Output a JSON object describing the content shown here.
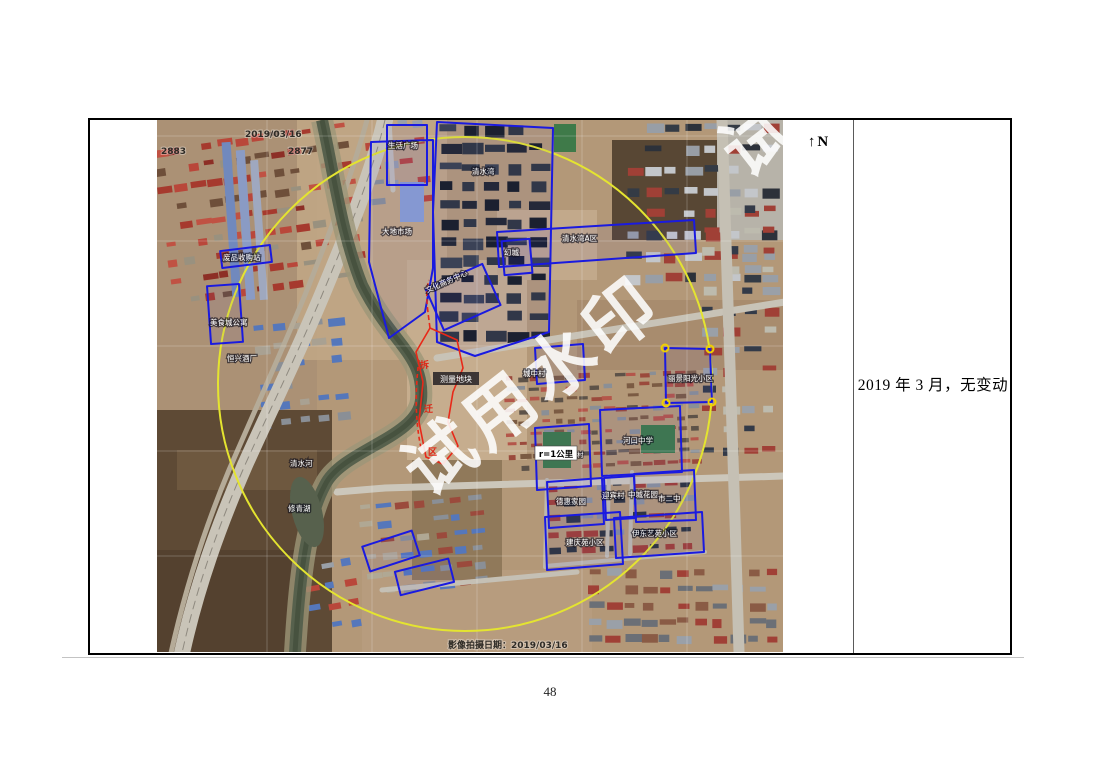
{
  "page": {
    "number": "48"
  },
  "panel": {
    "north_label": "↑N",
    "remark": "2019 年 3 月，无变动"
  },
  "map": {
    "watermark": "试用水印",
    "top_date": "2019/03/16",
    "grid_number_left": "2883",
    "grid_number_right": "2877",
    "bottom_caption": "影像拍摄日期：2019/03/16",
    "radius_label": "r=1公里",
    "red_parcel_label": "测量地块",
    "red_side_chars": [
      "拆",
      "迁",
      "区"
    ],
    "labels": [
      {
        "text": "生活广场"
      },
      {
        "text": "清水湾"
      },
      {
        "text": "大地市场"
      },
      {
        "text": "清水湾A区"
      },
      {
        "text": "幻城"
      },
      {
        "text": "文化商务中心"
      },
      {
        "text": "废品收购站"
      },
      {
        "text": "美食城公寓"
      },
      {
        "text": "恒兴酒厂"
      },
      {
        "text": "清水河"
      },
      {
        "text": "修青湖"
      },
      {
        "text": "吴头村"
      },
      {
        "text": "城中村"
      },
      {
        "text": "丽景阳光小区"
      },
      {
        "text": "河口中学"
      },
      {
        "text": "德惠家园"
      },
      {
        "text": "迎宾村"
      },
      {
        "text": "中城花园"
      },
      {
        "text": "市二中"
      },
      {
        "text": "伊东艺苑小区"
      },
      {
        "text": "建庆苑小区"
      }
    ],
    "colors": {
      "parcel_outline_blue": "#1a1ae0",
      "highlight_red": "#e82818",
      "radius_circle_yellow": "#e4e430"
    }
  }
}
